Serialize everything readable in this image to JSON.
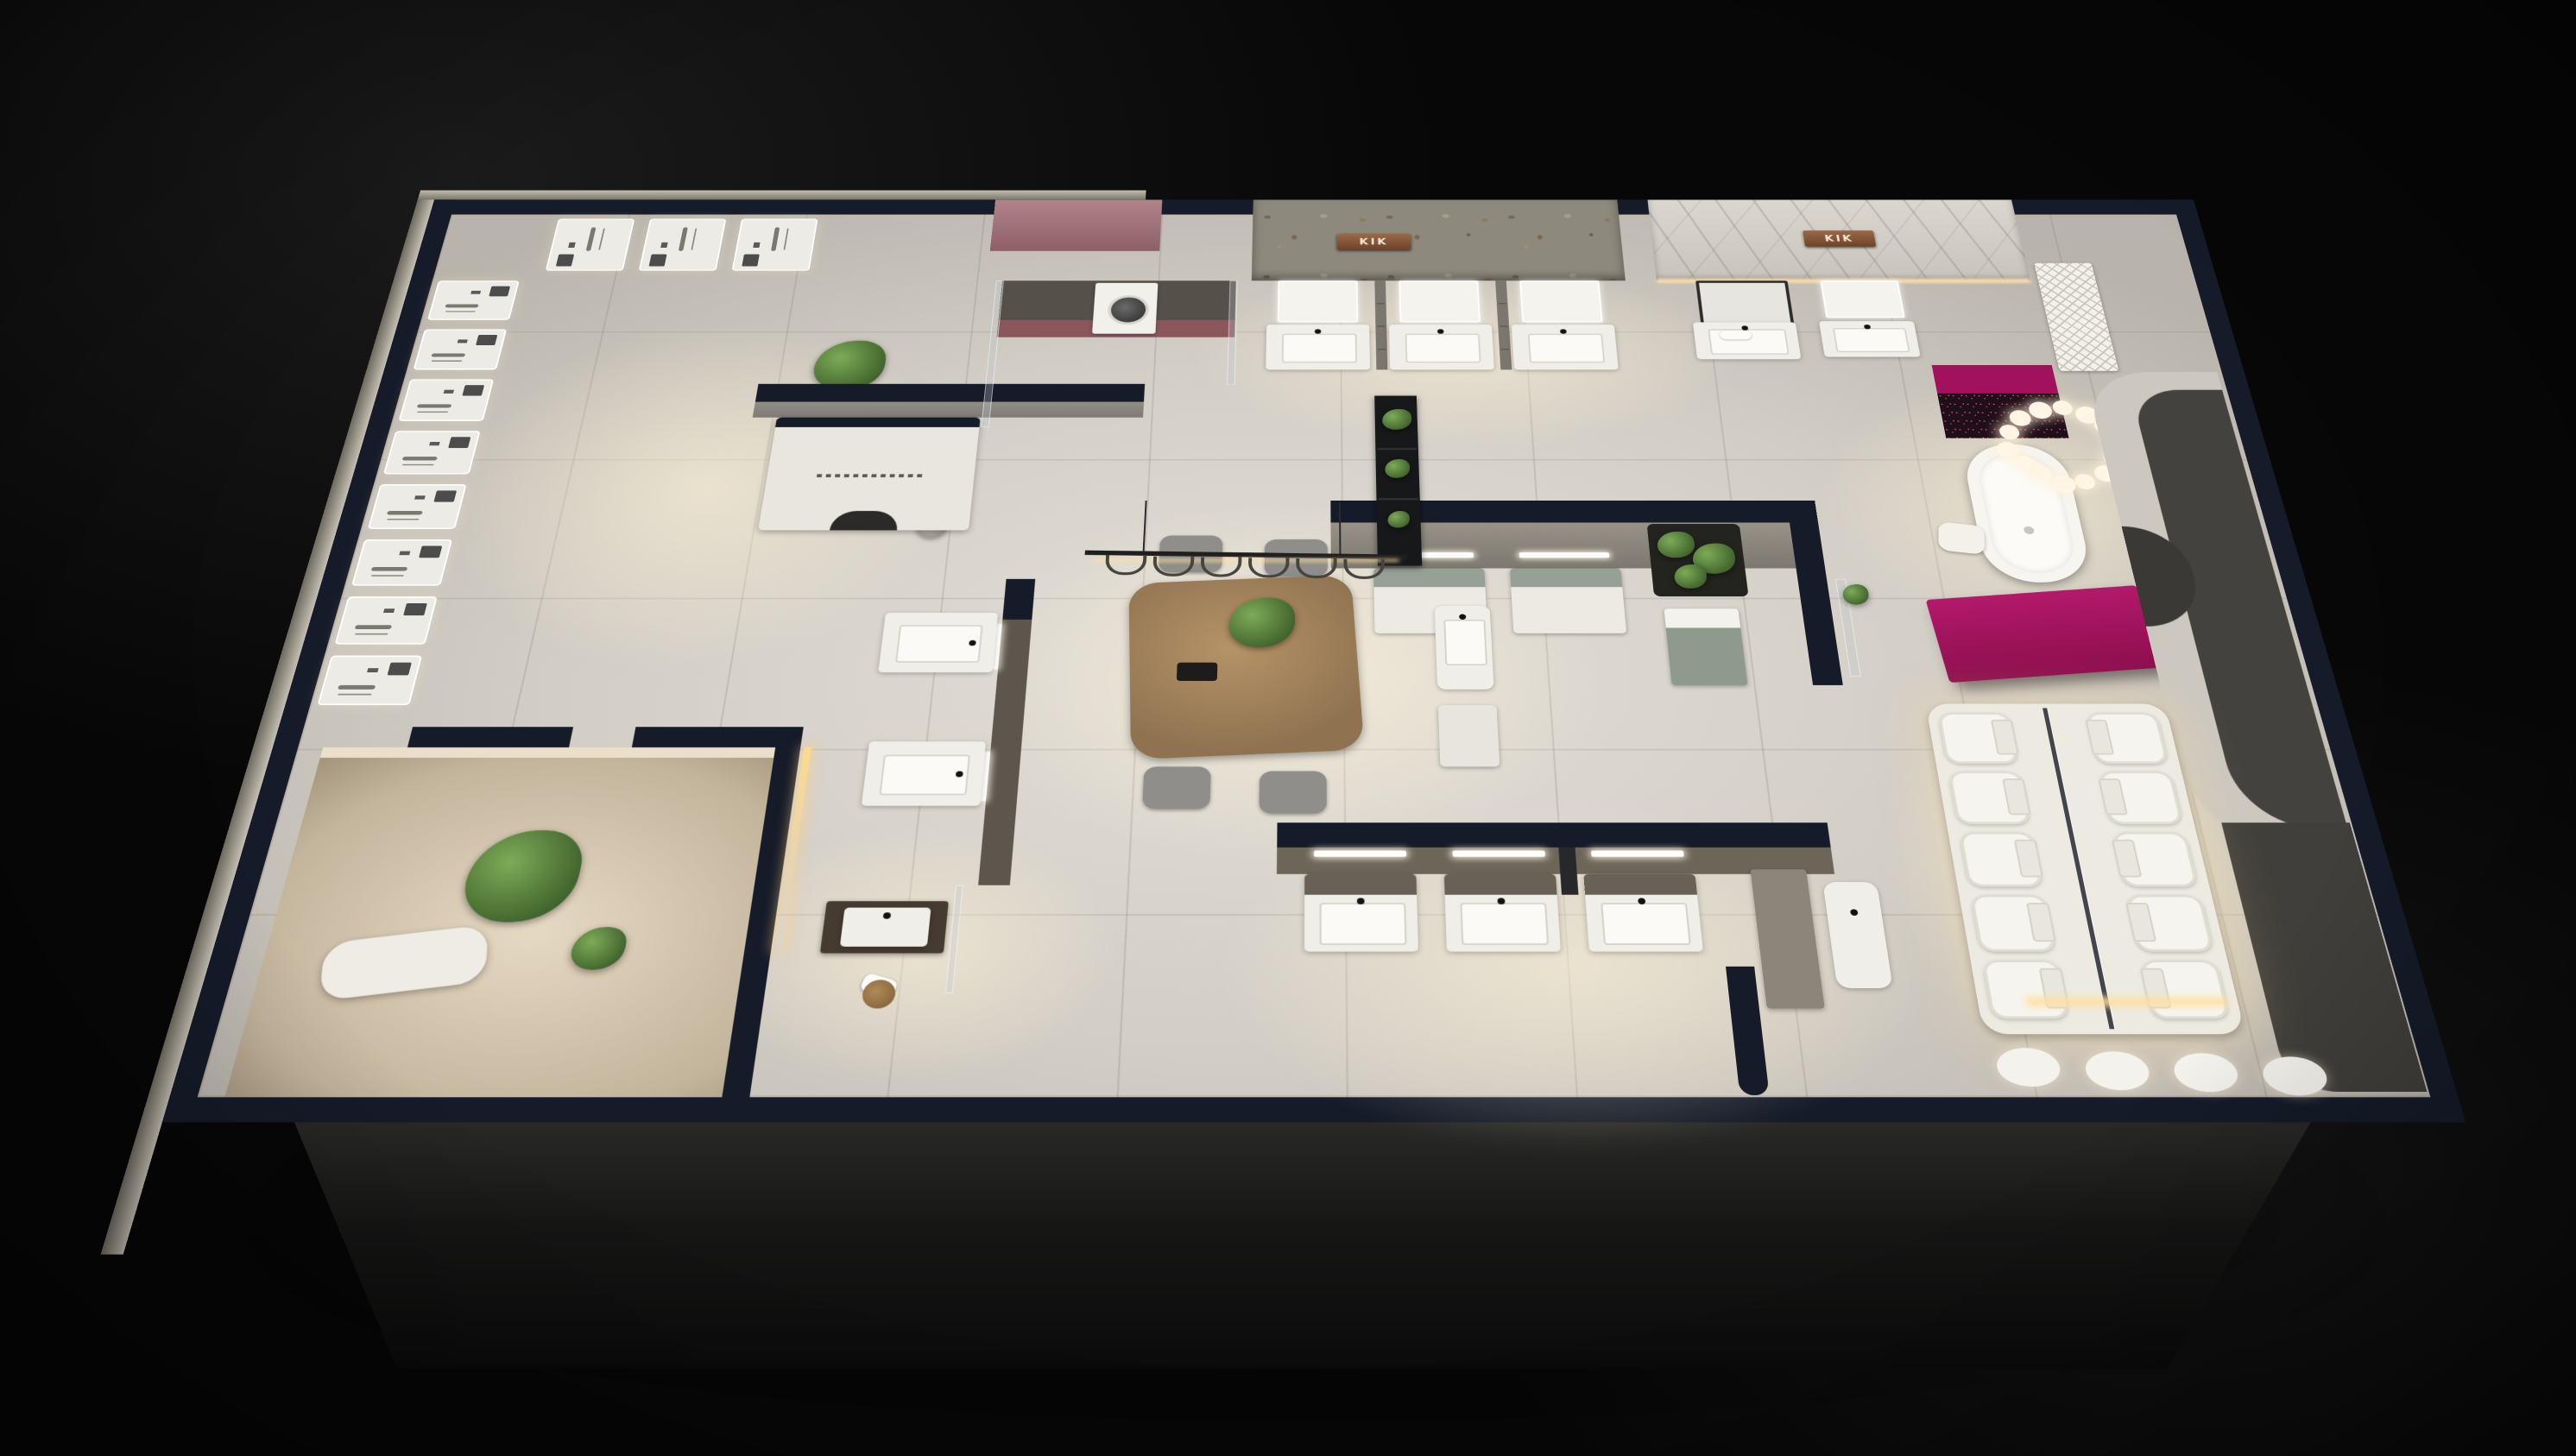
{
  "meta": {
    "description": "Night-time bird's-eye 3D render of a bathroom and sanitary-ware showroom floor plan",
    "view": "perspective top-down",
    "lighting": "dark exterior, warm interior spotlights"
  },
  "palette": {
    "background": "#070707",
    "wall_cap_navy": "#151b29",
    "floor_tile": "#d7d3cc",
    "accent_magenta": "#a8135f",
    "stone_wall": "#8e897d",
    "marble_wall": "#d6d2ca",
    "rose_panel": "#a97a7e",
    "maroon_cabinet": "#8a575c",
    "sage_green": "#97a094",
    "wood": "#a78a66",
    "warm_glow": "#ffdfae",
    "greenery": "#4c7a36",
    "copper_sign": "#8a5a35"
  },
  "signage": {
    "wall_sign_left": "KIK",
    "wall_sign_right": "KIK"
  },
  "zones": {
    "shower_display": {
      "label": "shower-panel display wall",
      "panels_left_wall": 8,
      "panels_top_wall": 3
    },
    "laundry_corner": {
      "label": "laundry display with washing machine",
      "washer_count": 1
    },
    "service_kiosk": {
      "label": "white service kiosk with arch and slogan strip"
    },
    "vanity_row_stone_wall": {
      "label": "LED-mirror vanities on stone wall",
      "units": 3
    },
    "vanity_row_center_island": {
      "label": "sage-top vanities on center island wall",
      "units": 2
    },
    "vanity_row_lower_island": {
      "label": "vanity displays on lower island wall",
      "units": 3
    },
    "double_vanity_partition": {
      "label": "double-sided vanity partition",
      "units": 2
    },
    "marble_wall_vanities": {
      "label": "vanities under marble wall",
      "units": 2
    },
    "meeting_area": {
      "label": "wood negotiation table with chairs and linear pendant",
      "chairs": 4,
      "pendant_hooks": 6
    },
    "plant_etagere": {
      "label": "black plant shelf",
      "plants": 3
    },
    "bathtub_zone": {
      "label": "freestanding bathtub with cloud chandelier",
      "chandelier_balls": 14
    },
    "reception_desk": {
      "label": "magenta reception desk"
    },
    "toilet_display": {
      "label": "backlit toilet display plinth with glass divider",
      "columns": 2,
      "rows": 5
    },
    "basin_row_bottom": {
      "label": "wall-hung basins at bottom wall",
      "units": 4
    },
    "lounge_room": {
      "label": "warm lounge corner with tree and chaise"
    },
    "arch_room": {
      "label": "curved arch feature room"
    },
    "green_bed": {
      "label": "indoor planting bed"
    }
  }
}
